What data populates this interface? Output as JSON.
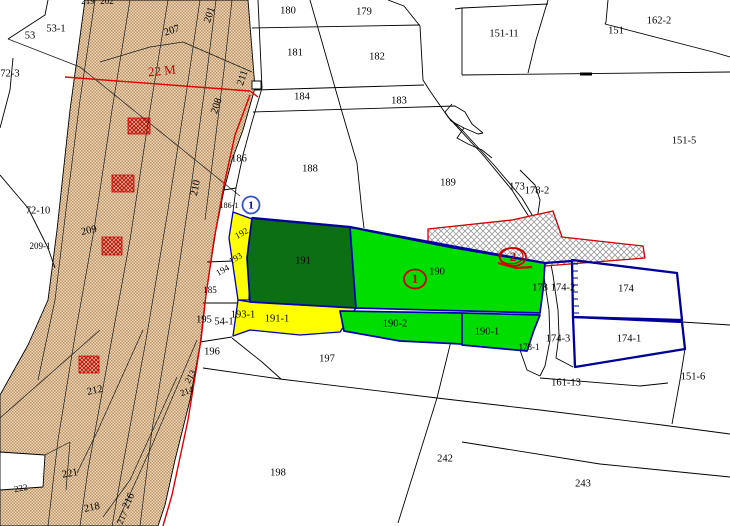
{
  "title": "cadastral-parcel-map",
  "colors": {
    "band_bg": "#eedcbd",
    "band_dot": "#bd9065",
    "hatch_line": "#9a9a9a",
    "hatch_bg": "#ffffff",
    "red": "#cc0000",
    "bright_red": "#e00000",
    "yellow": "#ffff00",
    "green_bright": "#00de00",
    "green_dark": "#0d6f14",
    "navy": "#000099",
    "blue": "#0000b4",
    "black": "#000000",
    "white": "#ffffff",
    "label": "#000000"
  },
  "map": {
    "width": 730,
    "height": 526,
    "shapes": [
      {
        "k": "pg",
        "n": "road-band",
        "p": "85,0 248,0 255,88 243,130 232,160 224,190 216,230 209,275 204,310 200,345 190,400 175,460 165,505 158,526 0,526 0,395 28,345 48,300 57,230 70,110",
        "f": "url(#p-band)",
        "st": "parcel",
        "i": "false"
      },
      {
        "k": "pl",
        "n": "band-line",
        "p": "95,0 80,100 66,210 55,300 38,380",
        "st": "thin"
      },
      {
        "k": "pl",
        "n": "band-line",
        "p": "130,0 112,110 94,230 76,330 58,440 48,526",
        "st": "thin"
      },
      {
        "k": "pl",
        "n": "band-line",
        "p": "168,0 150,110 130,240 108,360 88,470 80,526",
        "st": "thin"
      },
      {
        "k": "pl",
        "n": "band-line",
        "p": "200,0 186,95 168,210 146,340 122,470 112,526",
        "st": "thin"
      },
      {
        "k": "pl",
        "n": "band-line",
        "p": "216,0 206,80 192,180 174,300 152,430 140,526",
        "st": "thin"
      },
      {
        "k": "pl",
        "n": "band-line",
        "p": "232,0 224,70 214,150 205,220",
        "st": "thin"
      },
      {
        "k": "pl",
        "n": "band-line",
        "p": "100,62 150,47 183,42 252,72",
        "st": "thin"
      },
      {
        "k": "pl",
        "n": "band-line",
        "p": "8,39 80,67 240,196",
        "st": "thin"
      },
      {
        "k": "pl",
        "n": "band-line",
        "p": "100,330 0,418",
        "st": "thin"
      },
      {
        "k": "pl",
        "n": "band-line",
        "p": "143,330 98,430 77,473",
        "st": "thin"
      },
      {
        "k": "pl",
        "n": "band-line",
        "p": "197,340 150,450 117,523",
        "st": "thin"
      },
      {
        "k": "pl",
        "n": "band-line",
        "p": "177,377 130,480 103,517",
        "st": "thin"
      },
      {
        "k": "pl",
        "n": "band-line",
        "p": "45,455 70,442 66,490",
        "st": "thin"
      },
      {
        "k": "r",
        "n": "red-hatch-mark",
        "x": 128,
        "y": 118,
        "w": 22,
        "h": 16,
        "f": "url(#p-redmark)",
        "st": "redthin"
      },
      {
        "k": "r",
        "n": "red-hatch-mark",
        "x": 112,
        "y": 175,
        "w": 22,
        "h": 17,
        "f": "url(#p-redmark)",
        "st": "redthin"
      },
      {
        "k": "r",
        "n": "red-hatch-mark",
        "x": 102,
        "y": 237,
        "w": 20,
        "h": 18,
        "f": "url(#p-redmark)",
        "st": "redthin"
      },
      {
        "k": "r",
        "n": "red-hatch-mark",
        "x": 79,
        "y": 356,
        "w": 20,
        "h": 17,
        "f": "url(#p-redmark)",
        "st": "redthin"
      },
      {
        "k": "pg",
        "n": "white-notch",
        "p": "0,452 45,455 43,487 0,490",
        "f": "#ffffff",
        "st": "parcel"
      },
      {
        "k": "pl",
        "n": "parcel-line",
        "p": "48,0 45,15 8,39",
        "st": "parcel"
      },
      {
        "k": "pl",
        "n": "parcel-line",
        "p": "13,58 10,90 0,128",
        "st": "parcel"
      },
      {
        "k": "pl",
        "n": "parcel-line",
        "p": "0,175 28,208 48,248 55,268",
        "st": "parcel"
      },
      {
        "k": "pl",
        "n": "parcel-line",
        "p": "258,0 262,88 252,122 243,155 236,188 233,212",
        "st": "parcel"
      },
      {
        "k": "pl",
        "n": "parcel-line",
        "p": "252,28 420,25",
        "st": "parcel"
      },
      {
        "k": "pl",
        "n": "parcel-line",
        "p": "310,0 340,105 357,163 362,212 364,228",
        "st": "parcel"
      },
      {
        "k": "pl",
        "n": "parcel-line",
        "p": "255,90 424,85",
        "st": "parcel"
      },
      {
        "k": "pl",
        "n": "parcel-line",
        "p": "253,112 455,106 465,112 472,124 483,133",
        "st": "parcel"
      },
      {
        "k": "pl",
        "n": "parcel-line",
        "p": "388,0 404,6 420,26 423,80 430,91 448,117 463,131",
        "st": "parcel"
      },
      {
        "k": "pl",
        "n": "parcel-line",
        "p": "455,9 462,8 548,4",
        "st": "parcel"
      },
      {
        "k": "pl",
        "n": "parcel-line",
        "p": "462,8 462,75",
        "st": "parcel"
      },
      {
        "k": "pl",
        "n": "parcel-line",
        "p": "548,0 536,40 528,73",
        "st": "parcel"
      },
      {
        "k": "pl",
        "n": "parcel-line",
        "p": "608,0 606,22 605,24",
        "st": "parcel"
      },
      {
        "k": "pl",
        "n": "parcel-line",
        "p": "605,24 713,52 730,57",
        "st": "parcel"
      },
      {
        "k": "pl",
        "n": "parcel-line",
        "p": "462,75 730,72",
        "st": "parcel"
      },
      {
        "k": "pl",
        "n": "culvert-mark",
        "p": "580,74 592,74",
        "st": "thick"
      },
      {
        "k": "pl",
        "n": "parcel-line",
        "p": "448,117 483,155 512,190 531,220 537,235",
        "st": "parcel"
      },
      {
        "k": "pl",
        "n": "parcel-line",
        "p": "463,131 494,165 522,198 541,230 547,244",
        "st": "parcel"
      },
      {
        "k": "pl",
        "n": "parcel-line",
        "p": "452,104 445,112 451,121 464,128 478,134 483,133",
        "st": "parcel"
      },
      {
        "k": "pl",
        "n": "parcel-line",
        "p": "464,128 457,138 468,144 482,150 492,158",
        "st": "parcel"
      },
      {
        "k": "pl",
        "n": "parcel-line",
        "p": "520,170 535,185 540,200 537,220",
        "st": "parcel"
      },
      {
        "k": "pl",
        "n": "parcel-line",
        "p": "203,303 240,303",
        "st": "parcel"
      },
      {
        "k": "pl",
        "n": "parcel-line",
        "p": "207,262 233,261",
        "st": "parcel"
      },
      {
        "k": "pl",
        "n": "parcel-line",
        "p": "224,190 236,188",
        "st": "parcel"
      },
      {
        "k": "pl",
        "n": "parcel-line",
        "p": "200,342 232,337",
        "st": "parcel"
      },
      {
        "k": "pl",
        "n": "parcel-line",
        "p": "232,338 262,362 281,379",
        "st": "parcel"
      },
      {
        "k": "pl",
        "n": "road-line",
        "p": "203,368 280,379 437,398 540,410 662,425 730,434",
        "st": "parcel"
      },
      {
        "k": "pl",
        "n": "road-line",
        "p": "462,442 600,464 730,477",
        "st": "parcel"
      },
      {
        "k": "pl",
        "n": "parcel-line",
        "p": "453,333 437,398 398,523",
        "st": "parcel"
      },
      {
        "k": "pl",
        "n": "parcel-line",
        "p": "540,378 640,386 668,383",
        "st": "parcel"
      },
      {
        "k": "pl",
        "n": "parcel-line",
        "p": "685,349 680,380 672,424",
        "st": "parcel"
      },
      {
        "k": "pl",
        "n": "parcel-line",
        "p": "682,322 730,325",
        "st": "parcel"
      },
      {
        "k": "pl",
        "n": "parcel-line",
        "p": "520,350 527,370 540,376",
        "st": "parcel"
      },
      {
        "k": "pl",
        "n": "parcel-line",
        "p": "536,235 543,270 549,310 550,340 545,366 540,376",
        "st": "parcel"
      },
      {
        "k": "pl",
        "n": "parcel-line",
        "p": "547,244 553,275 558,310 559,335 556,358 573,367",
        "st": "parcel"
      },
      {
        "k": "r",
        "n": "building-mark",
        "x": 252,
        "y": 81,
        "w": 9,
        "h": 8,
        "f": "#ffffff",
        "st": "parcel"
      },
      {
        "k": "pg",
        "n": "restricted-hatch-strip",
        "p": "428,229 512,220 553,211 562,237 643,246 645,258 545,266 428,241",
        "f": "url(#p-hatch)",
        "st": "red"
      },
      {
        "k": "pg",
        "n": "parcel-192-193-yellow",
        "p": "233,212 252,219 249,300 238,300 229,238",
        "f": "yellow",
        "st": "blue1",
        "i": "true"
      },
      {
        "k": "pg",
        "n": "parcel-191-1-yellow",
        "p": "238,300 250,302 356,308 340,332 300,335 250,330 233,336",
        "f": "yellow",
        "st": "blue1",
        "i": "true"
      },
      {
        "k": "pg",
        "n": "parcel-191-darkgreen",
        "p": "252,218 350,227 356,308 250,302 247,258",
        "f": "green_dark",
        "st": "blue",
        "i": "true"
      },
      {
        "k": "pg",
        "n": "parcel-190-green",
        "p": "350,227 545,263 543,290 540,313 356,308",
        "f": "green_bright",
        "st": "blue",
        "i": "true"
      },
      {
        "k": "pg",
        "n": "parcel-190-2-green",
        "p": "340,311 462,313 462,344 400,341 344,331",
        "f": "green_bright",
        "st": "blue",
        "i": "true"
      },
      {
        "k": "pg",
        "n": "parcel-190-1-green",
        "p": "462,313 540,315 534,330 527,351 462,345",
        "f": "green_bright",
        "st": "blue",
        "i": "true"
      },
      {
        "k": "pl",
        "n": "navy-boundary",
        "p": "252,218 350,227 450,247 545,263 572,261",
        "st": "navy"
      },
      {
        "k": "pg",
        "n": "parcel-174-outline",
        "p": "572,260 677,273 682,320 573,317",
        "f": "none",
        "st": "navy",
        "i": "true"
      },
      {
        "k": "pg",
        "n": "parcel-174-1-outline",
        "p": "573,317 682,322 685,349 575,367",
        "f": "none",
        "st": "navy",
        "i": "true"
      },
      {
        "k": "pl",
        "n": "levee-tick",
        "p": "572,264 578,264",
        "st": "navythin"
      },
      {
        "k": "pl",
        "n": "levee-tick",
        "p": "572,271 578,271",
        "st": "navythin"
      },
      {
        "k": "pl",
        "n": "levee-tick",
        "p": "572,278 578,278",
        "st": "navythin"
      },
      {
        "k": "pl",
        "n": "levee-tick",
        "p": "572,285 578,285",
        "st": "navythin"
      },
      {
        "k": "pl",
        "n": "levee-tick",
        "p": "572,292 578,292",
        "st": "navythin"
      },
      {
        "k": "pl",
        "n": "levee-tick",
        "p": "572,299 578,299",
        "st": "navythin"
      },
      {
        "k": "pl",
        "n": "levee-tick",
        "p": "573,306 579,306",
        "st": "navythin"
      },
      {
        "k": "pl",
        "n": "levee-tick",
        "p": "573,313 579,313",
        "st": "navythin"
      },
      {
        "k": "pl",
        "n": "red-width-line",
        "p": "65,77 250,91 258,97",
        "st": "redline"
      },
      {
        "k": "pl",
        "n": "red-edge-line",
        "p": "250,95 235,135 224,185 214,240 206,295 201,340 188,420 172,495 163,526",
        "st": "redline"
      },
      {
        "k": "pl",
        "n": "red-segment",
        "p": "498,263 516,268 532,267",
        "st": "redthick"
      }
    ],
    "labels": [
      {
        "t": "53",
        "x": 30,
        "y": 36
      },
      {
        "t": "53-1",
        "x": 56,
        "y": 29
      },
      {
        "t": "72-3",
        "x": 10,
        "y": 74
      },
      {
        "t": "72-10",
        "x": 38,
        "y": 211
      },
      {
        "t": "219",
        "x": 88,
        "y": 2,
        "s": 9
      },
      {
        "t": "202",
        "x": 107,
        "y": 2,
        "s": 9
      },
      {
        "t": "201",
        "x": 210,
        "y": 15,
        "r": -72
      },
      {
        "t": "207",
        "x": 172,
        "y": 31,
        "r": -18
      },
      {
        "t": "22 M",
        "x": 162,
        "y": 72,
        "r": -6,
        "s": 13,
        "c": "red"
      },
      {
        "t": "211",
        "x": 243,
        "y": 78,
        "r": -72
      },
      {
        "t": "208",
        "x": 217,
        "y": 106,
        "r": -72
      },
      {
        "t": "210",
        "x": 196,
        "y": 188,
        "r": -78
      },
      {
        "t": "209",
        "x": 89,
        "y": 231,
        "r": -12
      },
      {
        "t": "209-1",
        "x": 40,
        "y": 247,
        "s": 9
      },
      {
        "t": "212",
        "x": 95,
        "y": 391,
        "r": -12
      },
      {
        "t": "213",
        "x": 191,
        "y": 377,
        "r": -60,
        "s": 9
      },
      {
        "t": "214",
        "x": 187,
        "y": 392,
        "r": -20,
        "s": 9
      },
      {
        "t": "221",
        "x": 70,
        "y": 474,
        "r": -10
      },
      {
        "t": "222",
        "x": 21,
        "y": 489,
        "r": -10,
        "s": 9
      },
      {
        "t": "218",
        "x": 92,
        "y": 508,
        "r": -12
      },
      {
        "t": "216",
        "x": 129,
        "y": 501,
        "r": -65
      },
      {
        "t": "217",
        "x": 123,
        "y": 518,
        "r": -65,
        "s": 9
      },
      {
        "t": "186",
        "x": 239,
        "y": 159
      },
      {
        "t": "186-1",
        "x": 229,
        "y": 206,
        "s": 8
      },
      {
        "t": "192",
        "x": 242,
        "y": 234,
        "r": -30,
        "s": 9
      },
      {
        "t": "193",
        "x": 236,
        "y": 259,
        "r": -30,
        "s": 9
      },
      {
        "t": "194",
        "x": 223,
        "y": 271,
        "r": -30,
        "s": 9
      },
      {
        "t": "185",
        "x": 210,
        "y": 291,
        "s": 9
      },
      {
        "t": "195",
        "x": 204,
        "y": 320
      },
      {
        "t": "54-1",
        "x": 224,
        "y": 322
      },
      {
        "t": "196",
        "x": 212,
        "y": 352
      },
      {
        "t": "197",
        "x": 327,
        "y": 359
      },
      {
        "t": "198",
        "x": 278,
        "y": 473
      },
      {
        "t": "180",
        "x": 288,
        "y": 11
      },
      {
        "t": "179",
        "x": 364,
        "y": 12
      },
      {
        "t": "181",
        "x": 295,
        "y": 53
      },
      {
        "t": "182",
        "x": 377,
        "y": 57
      },
      {
        "t": "184",
        "x": 302,
        "y": 97
      },
      {
        "t": "183",
        "x": 399,
        "y": 101
      },
      {
        "t": "151-11",
        "x": 504,
        "y": 34
      },
      {
        "t": "151",
        "x": 616,
        "y": 31
      },
      {
        "t": "162-2",
        "x": 659,
        "y": 21
      },
      {
        "t": "151-5",
        "x": 684,
        "y": 141
      },
      {
        "t": "188",
        "x": 310,
        "y": 169
      },
      {
        "t": "189",
        "x": 448,
        "y": 183
      },
      {
        "t": "173",
        "x": 517,
        "y": 187
      },
      {
        "t": "178-2",
        "x": 537,
        "y": 191
      },
      {
        "t": "191",
        "x": 303,
        "y": 261
      },
      {
        "t": "190",
        "x": 437,
        "y": 272
      },
      {
        "t": "190-2",
        "x": 395,
        "y": 324
      },
      {
        "t": "190-1",
        "x": 487,
        "y": 332
      },
      {
        "t": "191-1",
        "x": 277,
        "y": 319
      },
      {
        "t": "193-1",
        "x": 243,
        "y": 315
      },
      {
        "t": "174",
        "x": 626,
        "y": 289
      },
      {
        "t": "174-1",
        "x": 629,
        "y": 339
      },
      {
        "t": "174-2",
        "x": 563,
        "y": 288
      },
      {
        "t": "178",
        "x": 540,
        "y": 288
      },
      {
        "t": "174-3",
        "x": 558,
        "y": 339
      },
      {
        "t": "178-1",
        "x": 529,
        "y": 348,
        "s": 9
      },
      {
        "t": "161-13",
        "x": 566,
        "y": 383
      },
      {
        "t": "151-6",
        "x": 693,
        "y": 377
      },
      {
        "t": "242",
        "x": 445,
        "y": 459
      },
      {
        "t": "243",
        "x": 583,
        "y": 484
      }
    ],
    "markers": [
      {
        "n": "blue-station-marker-1",
        "shape": "circle",
        "x": 251,
        "y": 205,
        "rx": 8.5,
        "ry": 8.5,
        "stroke": "blue",
        "text": "1",
        "tc": "navy",
        "ts": 11
      },
      {
        "n": "red-circled-1",
        "shape": "ellipse",
        "x": 415,
        "y": 279,
        "rx": 11,
        "ry": 9.5,
        "stroke": "red",
        "text": "1",
        "tc": "red",
        "ts": 13
      },
      {
        "n": "red-circled-2",
        "shape": "ellipse",
        "x": 513,
        "y": 257,
        "rx": 13,
        "ry": 9,
        "stroke": "red",
        "text": "2",
        "tc": "red",
        "ts": 13,
        "double": true
      }
    ]
  }
}
